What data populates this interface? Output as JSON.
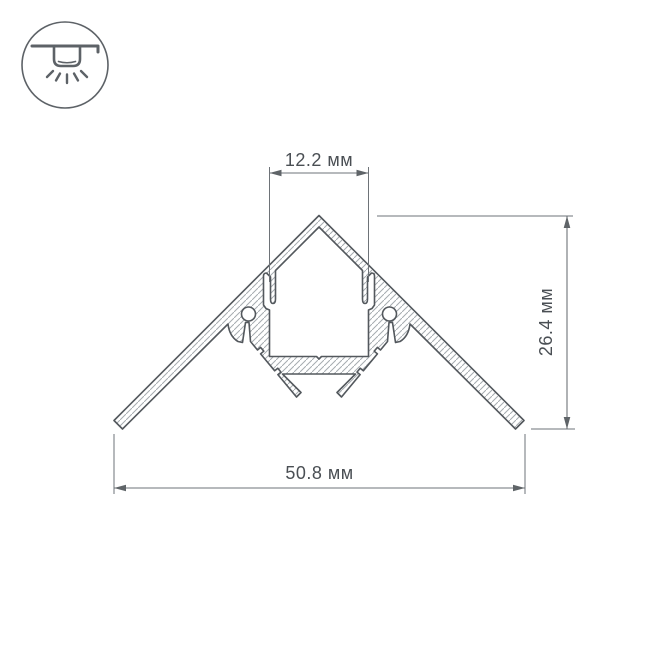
{
  "drawing": {
    "type": "led-profile-cross-section-technical-drawing",
    "dimensions": {
      "top_width": {
        "label": "12.2 мм"
      },
      "height": {
        "label": "26.4 мм"
      },
      "bottom_width": {
        "label": "50.8 мм"
      }
    },
    "icon": {
      "name": "ceiling-surface-mount-light-icon"
    },
    "colors": {
      "outline": "#53585d",
      "dimension_lines": "#6e7378",
      "dimension_text": "#4a4f54",
      "hatch": "#a6abb0",
      "background": "#ffffff"
    }
  }
}
